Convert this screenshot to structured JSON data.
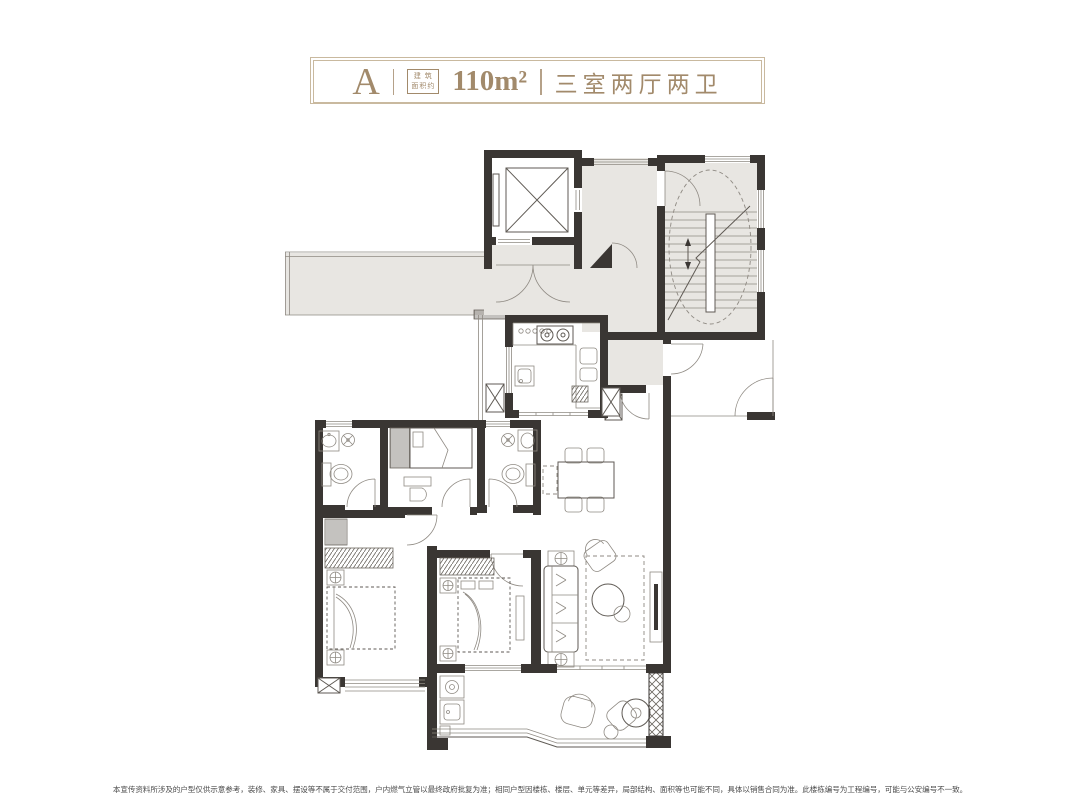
{
  "header": {
    "type_label": "A",
    "area_caption_line1": "建 筑",
    "area_caption_line2": "面积约",
    "area_value": "110m²",
    "layout_label": "三室两厅两卫"
  },
  "footer": {
    "disclaimer": "本宣传资料所涉及的户型仅供示意参考，装修、家具、摆设等不属于交付范围，户内燃气立管以最终政府批复为准；相同户型因楼栋、楼层、单元等差异，局部结构、面积等也可能不同，具体以销售合同为准。此楼栋编号为工程编号，可能与公安编号不一致。"
  },
  "colors": {
    "accent": "#a28a6b",
    "accent_light": "#c9b99f",
    "wall": "#3a3633",
    "grayfill": "#e8e6e2",
    "stroke": "#5f5a54",
    "thin": "#8f8a83",
    "text": "#4c4c4c",
    "bg": "#ffffff"
  }
}
